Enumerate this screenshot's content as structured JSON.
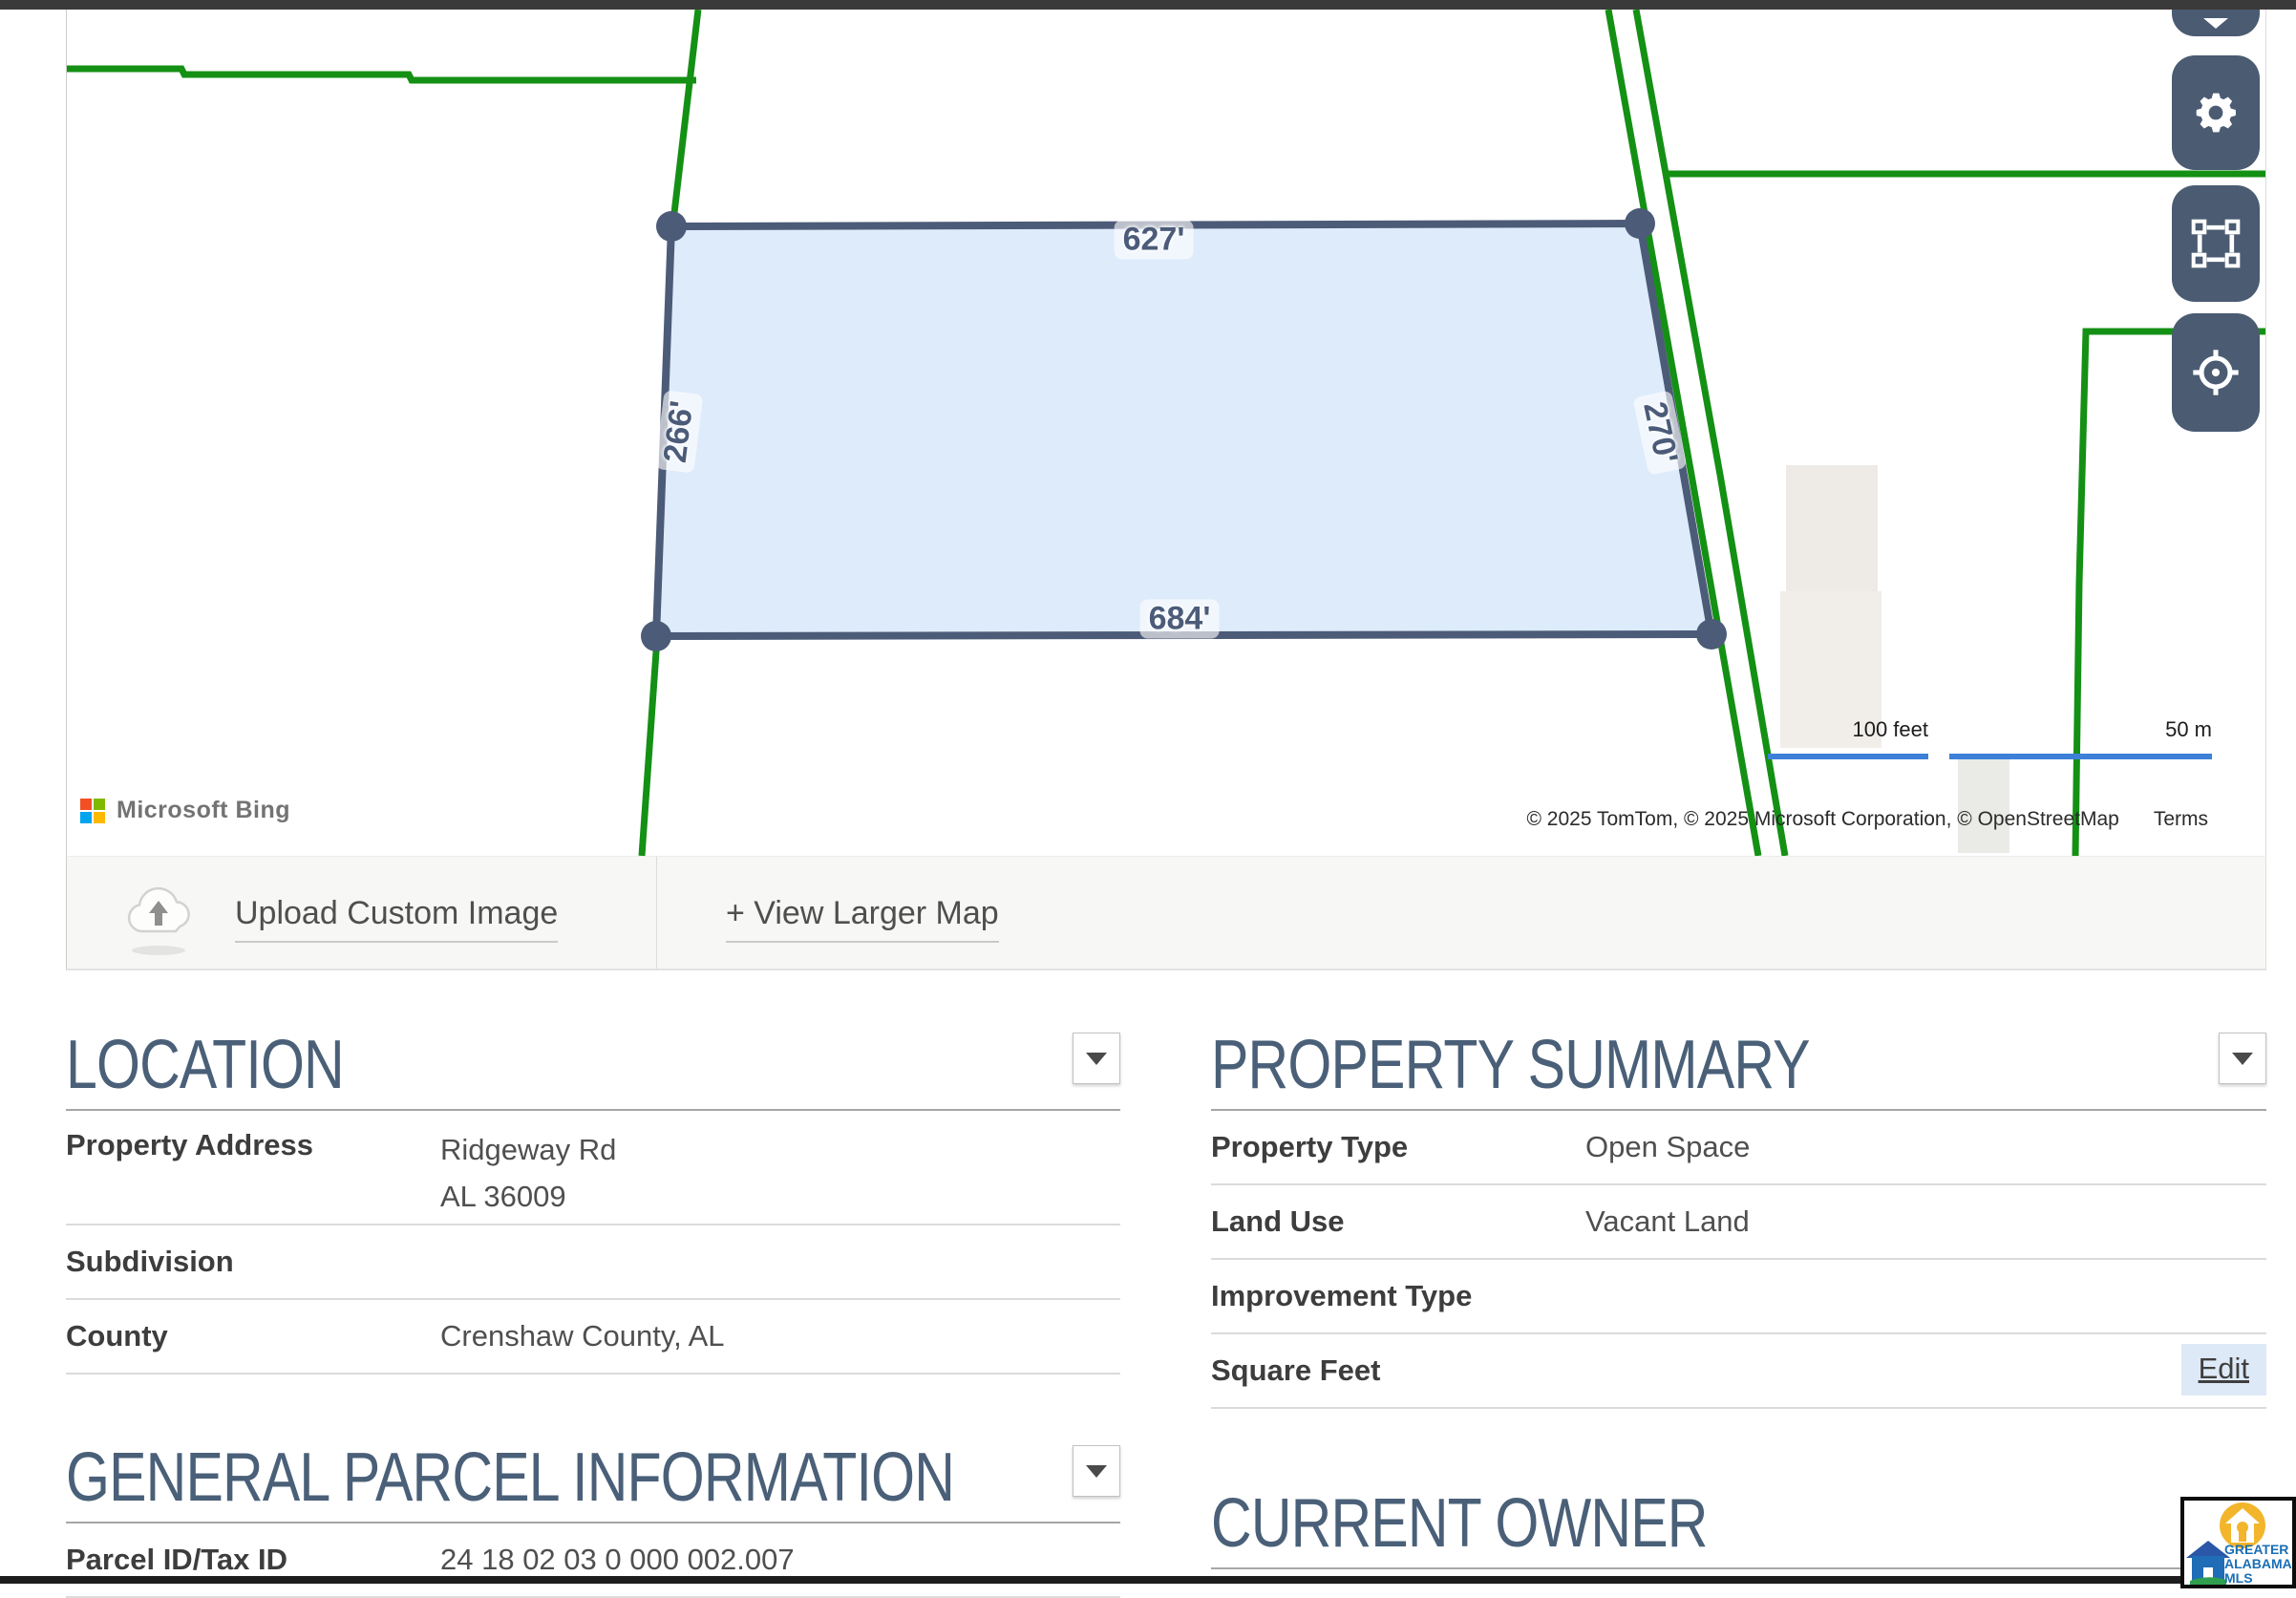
{
  "map": {
    "measurements": {
      "top": "627'",
      "left": "266'",
      "bottom": "684'",
      "right": "270'"
    },
    "scale": {
      "feet": "100 feet",
      "meters": "50 m"
    },
    "copyright": "© 2025 TomTom, © 2025 Microsoft Corporation, © OpenStreetMap",
    "terms": "Terms",
    "provider": "Microsoft Bing"
  },
  "actions": {
    "upload": "Upload Custom Image",
    "view_larger": "+ View Larger Map"
  },
  "sections": {
    "location": {
      "title": "LOCATION",
      "rows": [
        {
          "label": "Property Address",
          "value": "Ridgeway Rd",
          "value2": "AL 36009"
        },
        {
          "label": "Subdivision",
          "value": ""
        },
        {
          "label": "County",
          "value": "Crenshaw County, AL"
        }
      ]
    },
    "property_summary": {
      "title": "PROPERTY SUMMARY",
      "rows": [
        {
          "label": "Property Type",
          "value": "Open Space"
        },
        {
          "label": "Land Use",
          "value": "Vacant Land"
        },
        {
          "label": "Improvement Type",
          "value": ""
        },
        {
          "label": "Square Feet",
          "value": "",
          "action": "Edit"
        }
      ]
    },
    "general_parcel": {
      "title": "GENERAL PARCEL INFORMATION",
      "rows": [
        {
          "label": "Parcel ID/Tax ID",
          "value": "24 18 02 03 0 000 002.007"
        }
      ]
    },
    "current_owner": {
      "title": "CURRENT OWNER"
    }
  },
  "logo": {
    "line1": "GREATER",
    "line2": "ALABAMA",
    "line3": "MLS"
  },
  "colors": {
    "parcel_line_green": "#149014",
    "parcel_outline": "#4c5b77",
    "parcel_fill": "#d7e7f9",
    "map_button": "#4a5b72",
    "scale_bar_blue": "#3d80d8",
    "heading": "#4a6078",
    "bing_red": "#f25022",
    "bing_green": "#7fba00",
    "bing_blue": "#00a4ef",
    "bing_yellow": "#ffb900"
  }
}
